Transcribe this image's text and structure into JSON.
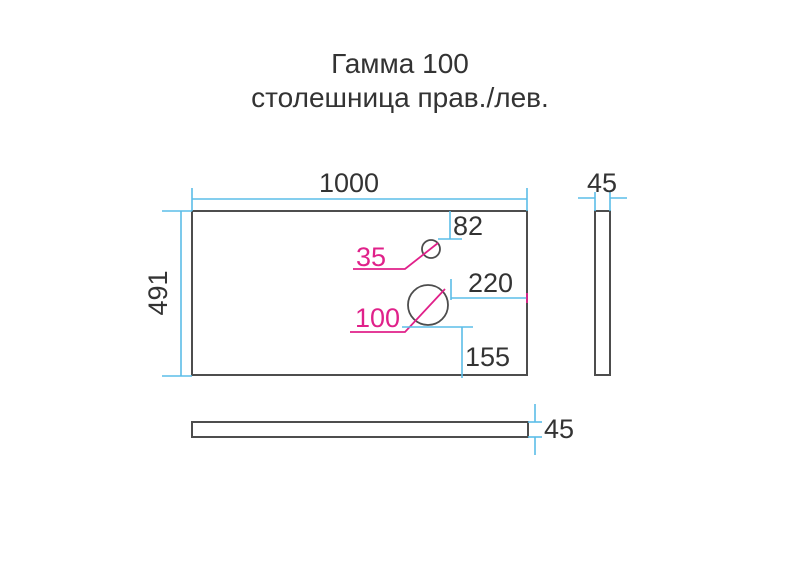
{
  "title": {
    "line1": "Гамма 100",
    "line2": "столешница прав./лев."
  },
  "views": {
    "top": {
      "width_mm": "1000",
      "depth_mm": "491",
      "hole_small_diameter_mm": "35",
      "hole_small_offset_from_top_mm": "82",
      "hole_large_diameter_mm": "100",
      "hole_large_offset_from_right_mm": "220",
      "hole_large_offset_from_bottom_mm": "155"
    },
    "side": {
      "thickness_mm": "45"
    },
    "front": {
      "thickness_mm": "45"
    }
  },
  "colors": {
    "outline": "#4D4D4D",
    "dimension_line": "#5BBDE8",
    "accent": "#E0218A",
    "text": "#333333"
  }
}
